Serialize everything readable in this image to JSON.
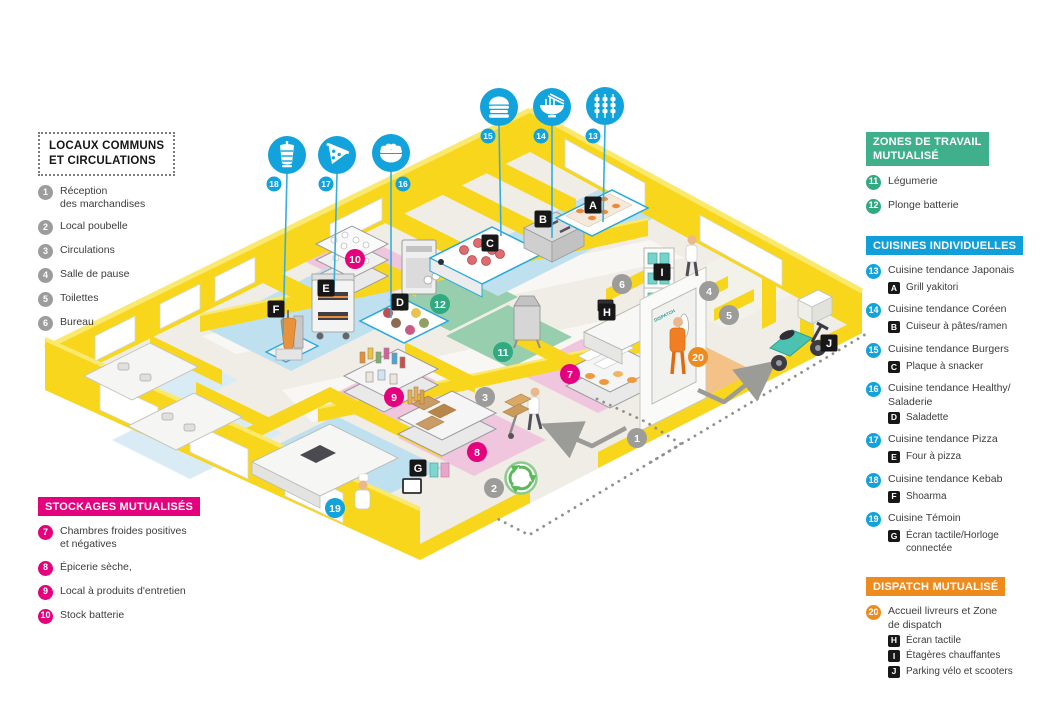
{
  "palette": {
    "wall_yellow": "#F7D61C",
    "floor_blue": "#BFE0EF",
    "floor_green": "#97CFAE",
    "floor_pink": "#EFC6DE",
    "floor_orange": "#F4C186",
    "badge_blue": "#12A3DC",
    "badge_green": "#31A981",
    "badge_magenta": "#E5007D",
    "badge_orange": "#EE8B1F",
    "badge_gray": "#9C9C9B",
    "header_green": "#3FAF8C",
    "header_blue": "#109FD9",
    "header_magenta": "#E5007D",
    "header_orange": "#EE8B1F"
  },
  "legend_common": {
    "title": "LOCAUX COMMUNS\nET CIRCULATIONS",
    "items": [
      {
        "num": "1",
        "label": "Réception\ndes marchandises"
      },
      {
        "num": "2",
        "label": "Local poubelle"
      },
      {
        "num": "3",
        "label": "Circulations"
      },
      {
        "num": "4",
        "label": "Salle de pause"
      },
      {
        "num": "5",
        "label": "Toilettes"
      },
      {
        "num": "6",
        "label": "Bureau"
      }
    ]
  },
  "legend_storage": {
    "title": "STOCKAGES MUTUALISÉS",
    "items": [
      {
        "num": "7",
        "label": "Chambres froides positives\net négatives"
      },
      {
        "num": "8",
        "label": "Épicerie sèche,"
      },
      {
        "num": "9",
        "label": "Local à produits d'entretien"
      },
      {
        "num": "10",
        "label": "Stock batterie"
      }
    ]
  },
  "legend_shared": {
    "title": "ZONES DE TRAVAIL\nMUTUALISÉ",
    "items": [
      {
        "num": "11",
        "label": "Légumerie"
      },
      {
        "num": "12",
        "label": "Plonge batterie"
      }
    ]
  },
  "legend_kitchens": {
    "title": "CUISINES INDIVIDUELLES",
    "items": [
      {
        "num": "13",
        "label": "Cuisine tendance Japonais",
        "sub_letter": "A",
        "sub_label": "Grill yakitori"
      },
      {
        "num": "14",
        "label": "Cuisine tendance Coréen",
        "sub_letter": "B",
        "sub_label": "Cuiseur à pâtes/ramen"
      },
      {
        "num": "15",
        "label": "Cuisine tendance Burgers",
        "sub_letter": "C",
        "sub_label": "Plaque à snacker"
      },
      {
        "num": "16",
        "label": "Cuisine tendance Healthy/\nSaladerie",
        "sub_letter": "D",
        "sub_label": "Saladette"
      },
      {
        "num": "17",
        "label": "Cuisine tendance Pizza",
        "sub_letter": "E",
        "sub_label": "Four à pizza"
      },
      {
        "num": "18",
        "label": "Cuisine tendance Kebab",
        "sub_letter": "F",
        "sub_label": "Shoarma"
      },
      {
        "num": "19",
        "label": "Cuisine Témoin",
        "sub_letter": "G",
        "sub_label": "Écran tactile/Horloge\nconnectée"
      }
    ]
  },
  "legend_dispatch": {
    "title": "DISPATCH MUTUALISÉ",
    "item_num": "20",
    "item_label": "Accueil livreurs et Zone\nde dispatch",
    "subs": [
      {
        "letter": "H",
        "label": "Écran tactile"
      },
      {
        "letter": "I",
        "label": "Étagères chauffantes"
      },
      {
        "letter": "J",
        "label": "Parking vélo et scooters"
      }
    ]
  },
  "plan": {
    "door_label": "DISPATCH",
    "number_badges": [
      {
        "value": "1",
        "kind": "gray"
      },
      {
        "value": "2",
        "kind": "gray"
      },
      {
        "value": "3",
        "kind": "gray"
      },
      {
        "value": "4",
        "kind": "gray"
      },
      {
        "value": "5",
        "kind": "gray"
      },
      {
        "value": "6",
        "kind": "gray"
      },
      {
        "value": "7",
        "kind": "magenta"
      },
      {
        "value": "8",
        "kind": "magenta"
      },
      {
        "value": "9",
        "kind": "magenta"
      },
      {
        "value": "10",
        "kind": "magenta"
      },
      {
        "value": "11",
        "kind": "green"
      },
      {
        "value": "12",
        "kind": "green"
      },
      {
        "value": "19",
        "kind": "blue"
      },
      {
        "value": "20",
        "kind": "orange"
      }
    ],
    "letter_badges": [
      {
        "value": "A"
      },
      {
        "value": "B"
      },
      {
        "value": "C"
      },
      {
        "value": "D"
      },
      {
        "value": "E"
      },
      {
        "value": "F"
      },
      {
        "value": "G"
      },
      {
        "value": "H"
      },
      {
        "value": "I"
      },
      {
        "value": "J"
      }
    ],
    "food_icons": [
      {
        "num": "18",
        "icon": "kebab-icon"
      },
      {
        "num": "17",
        "icon": "pizza-icon"
      },
      {
        "num": "16",
        "icon": "salad-icon"
      },
      {
        "num": "15",
        "icon": "burger-icon"
      },
      {
        "num": "14",
        "icon": "ramen-icon"
      },
      {
        "num": "13",
        "icon": "yakitori-icon"
      }
    ]
  }
}
